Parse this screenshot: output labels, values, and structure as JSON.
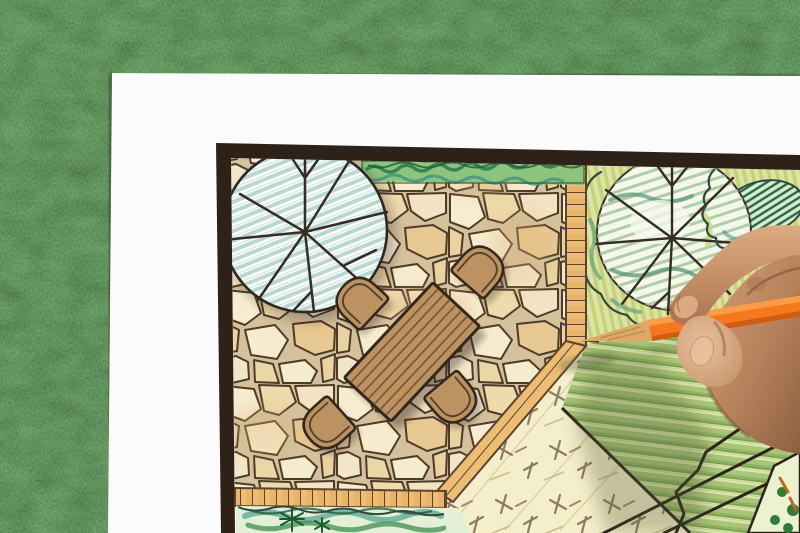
{
  "scene": {
    "description": "Photograph of a designer's hand holding an orange colored pencil over a hand-drawn backyard garden landscape plan; the white plan sheet lies on green artificial grass.",
    "objects": {
      "background": "artificial-grass",
      "sheet": "white-paper-plan-sheet",
      "plan_border": "dark-frame-border",
      "tree_left": "round-tree-symbol-with-radial-branches-teal-hatch",
      "tree_right": "round-tree-symbol-with-radial-branches-green-scribble",
      "hedge": "clipped-hedge-strip",
      "patio": "irregular-flagstone-patio",
      "edging": "brick-soldier-course-edging",
      "table": "rectangular-plank-dining-table",
      "chair_count": 4,
      "lawn": "striped-lawn-panel",
      "groundcover": "cross-hatched-groundcover-bed",
      "planting_bed": "conifer-and-shrub-planting-bed",
      "shrubs": "scalloped-shrub-outlines",
      "flower_bed": "corner-flower-bed",
      "pencil": "orange-colored-pencil",
      "hand": "right-hand-gripping-pencil"
    }
  },
  "palette": {
    "grass": "#4E7C43",
    "paper": "#FAFBFA",
    "frame": "#2E2118",
    "stone_gap": "#D3C29C",
    "stone_outline": "#4E3A28",
    "brick": "#ECBD72",
    "brick_line": "#5C4430",
    "furniture": "#BC9261",
    "furniture_outline": "#33281C",
    "plank_line": "#7A5A39",
    "tree_fill": "#FDFEFD",
    "tree_hatch": "#B7D7CF",
    "ink": "#352C24",
    "hedge_base": "#8CC47C",
    "hedge_dark": "#2E7D52",
    "hedge_teal": "#3F9380",
    "chartreuse": "#DDE3A2",
    "lawn_stripe": "#8FB465",
    "groundcover": "#F5EECB",
    "cross_mark": "#8D7C63",
    "pencil_orange": "#F4791E",
    "pencil_highlight": "#FF9F4A",
    "pencil_shade": "#CF5C10",
    "pencil_wood": "#DCA967",
    "pencil_lead": "#4A3E33",
    "skin_light": "#DCAB80",
    "skin_mid": "#B5825C",
    "skin_shadow": "#8F5F41"
  }
}
